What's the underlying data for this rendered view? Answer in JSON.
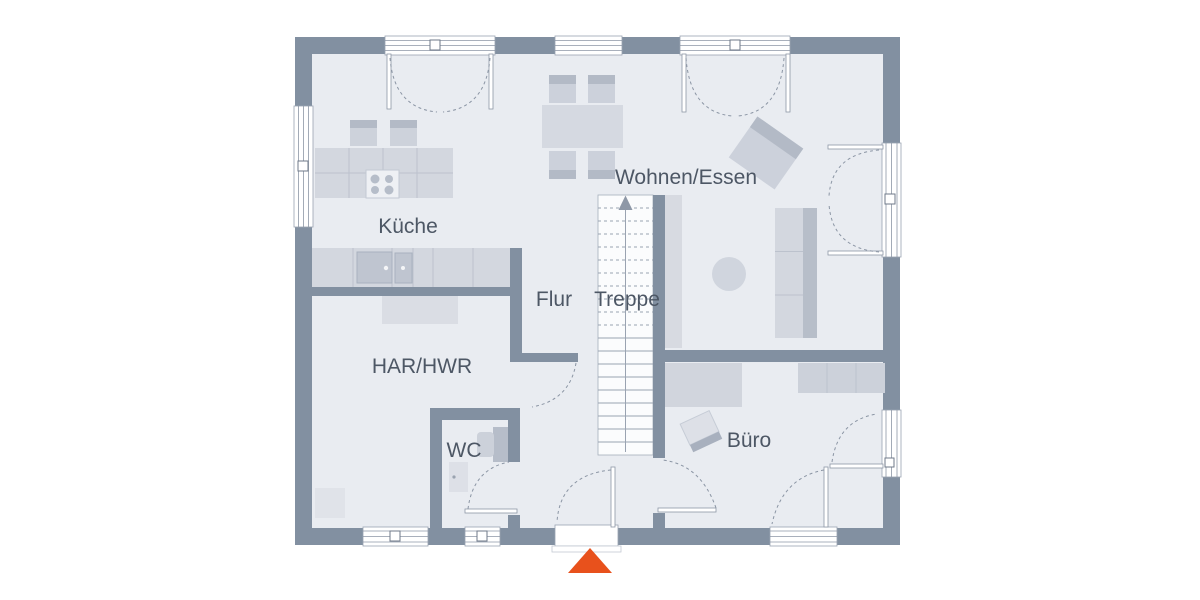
{
  "floor_plan": {
    "title": "Erdgeschoss Grundriss",
    "rooms": [
      {
        "name": "kueche",
        "label": "Küche"
      },
      {
        "name": "wohnen-essen",
        "label": "Wohnen/Essen"
      },
      {
        "name": "flur",
        "label": "Flur"
      },
      {
        "name": "treppe",
        "label": "Treppe"
      },
      {
        "name": "har-hwr",
        "label": "HAR/HWR"
      },
      {
        "name": "wc",
        "label": "WC"
      },
      {
        "name": "buero",
        "label": "Büro"
      }
    ],
    "colors": {
      "wall": "#8290a1",
      "floor": "#e9ecf1",
      "furniture": "#d3d7df",
      "furniture_dark": "#b3bac6",
      "appliance": "#bfc5d0",
      "stair_background": "#fbfcfd",
      "line": "#8d97a6",
      "label_text": "#4d5765",
      "entrance_marker": "#e8511c",
      "page_background": "#ffffff"
    },
    "symbols": {
      "entrance_marker": "triangle-up",
      "stair_direction": "arrow-up"
    }
  }
}
